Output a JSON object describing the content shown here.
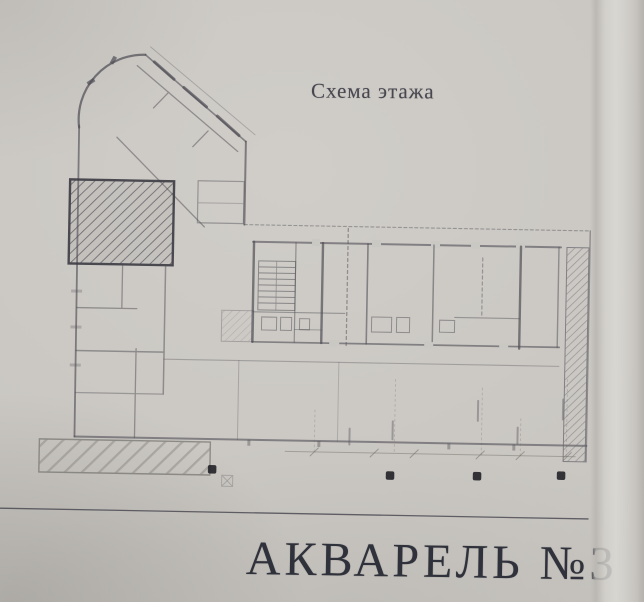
{
  "page": {
    "title": "Схема этажа",
    "footer": "АКВАРЕЛЬ №3"
  },
  "plan": {
    "kind": "scanned floor plan photo",
    "highlighted_unit": "hatched rectangular room in upper-left wing",
    "marker_dot_count": 4
  },
  "colors": {
    "paper": "#c9c6c1",
    "ink": "#504f56",
    "title_text": "#484750",
    "footer_text": "#2f313b"
  }
}
